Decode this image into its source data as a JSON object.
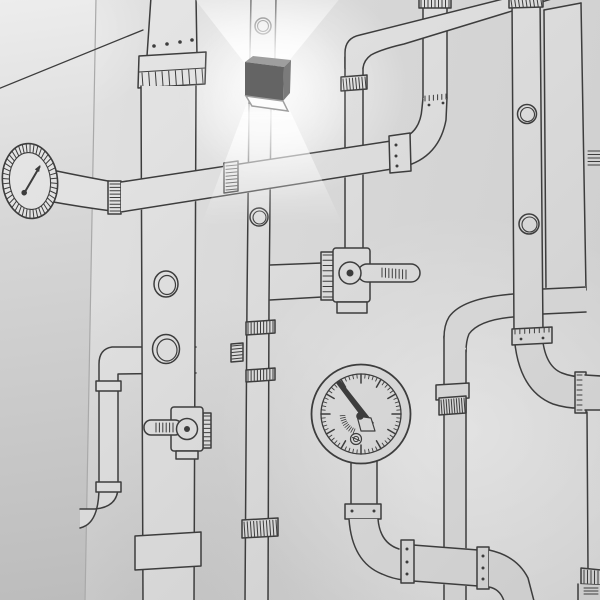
{
  "scene": {
    "setting": "corner of a white room photographed in black and white",
    "art": "hand-drawn black marker mural of industrial pipes, valves and gauges",
    "fixture": "dark cube wall lamp, lit, casting light cones up and down"
  },
  "wall": {
    "base_color": "#d8d8d8",
    "left_face_top": "#ededed",
    "left_face_bottom": "#bcbcbc",
    "fill_light": "#e8e8e8",
    "fill_mid": "#d9d9d9",
    "fill_dark": "#cccccc",
    "corner_line": "#a9a9a9"
  },
  "mural": {
    "ink_color": "#3d3d3d",
    "elements": {
      "left_gauge": "small oval gauge with tick ring and needle, joined to horizontal pipe",
      "main_horizontal_pipe": "long horizontal pipe with ribbed flange and coupling, elbowing up at right",
      "top_duct": "wide vertical duct with riveted flange, portholes, lever valve and collar",
      "lamp_pipe": "narrow vertical pipe with portholes passing behind the lamp",
      "center_pipe": "vertical pipe with ribbed band, elbow to top-right, ending in lever valve",
      "center_valve": "valve with round hub and right-pointing lever",
      "duct_valve": "valve with round hub and left-pointing lever",
      "big_gauge": "large round gauge with needle, minor and major ticks and screw",
      "drain_pipe": "riveted S-bend pipe running to bottom edge",
      "tall_right_pipe": "vertical pipe with two portholes elbowing off right edge",
      "right_duct": "wide duct along right edge",
      "left_branch_pipe": "pipe leaving duct, dropping down and turning toward room corner"
    }
  },
  "lamp": {
    "top_color": "#9e9e9e",
    "front_color": "#646464",
    "side_color": "#7b7b7b",
    "panel_color": "#fdfdfd",
    "glow_color": "#ffffff"
  }
}
